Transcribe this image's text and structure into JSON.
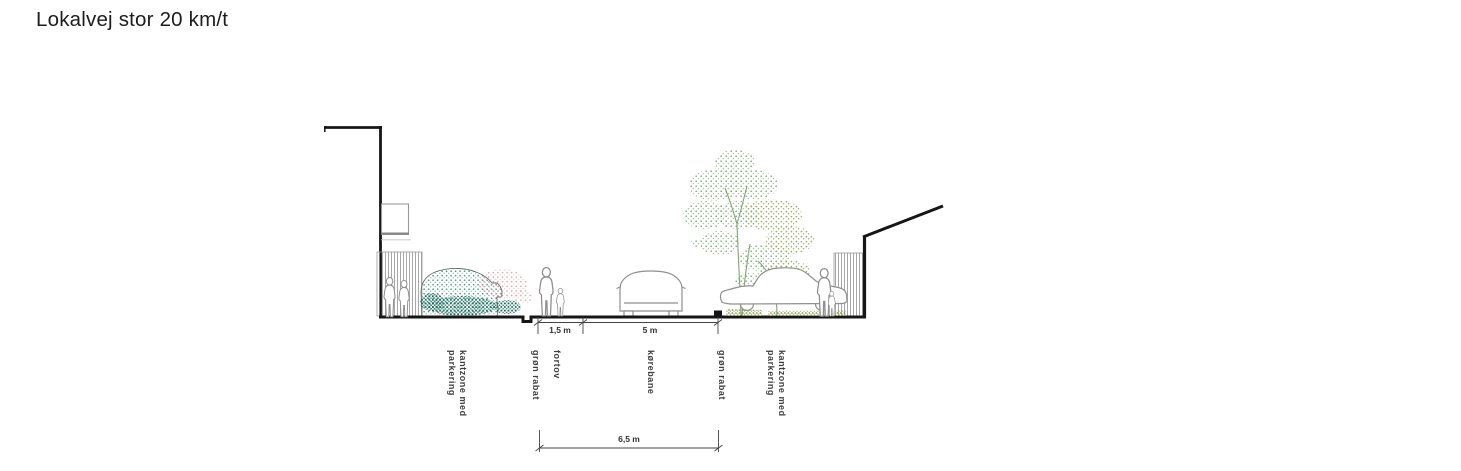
{
  "title": "Lokalvej stor 20 km/t",
  "diagram": {
    "zones": [
      {
        "id": "kantzone-left",
        "label": "kantzone med\nparkering"
      },
      {
        "id": "groen-rabat-left",
        "label": "grøn rabat"
      },
      {
        "id": "fortov",
        "label": "fortov"
      },
      {
        "id": "koerebane",
        "label": "kørebane"
      },
      {
        "id": "groen-rabat-right",
        "label": "grøn rabat"
      },
      {
        "id": "kantzone-right",
        "label": "kantzone med\nparkering"
      }
    ],
    "dimensions": {
      "fortov": "1,5 m",
      "koerebane": "5 m",
      "total": "6,5 m"
    },
    "colors": {
      "line": "#161616",
      "figure_outline": "#8f8f8f",
      "bush_teal": "#4f968a",
      "bush_teal_dark": "#206a5b",
      "bush_pink": "#db9aa7",
      "tree_green": "#7fae78",
      "tree_olive": "#a4ab60",
      "grass": "#87994f",
      "dimension_text": "#333333",
      "zone_label_text": "#3f3f3f"
    }
  }
}
